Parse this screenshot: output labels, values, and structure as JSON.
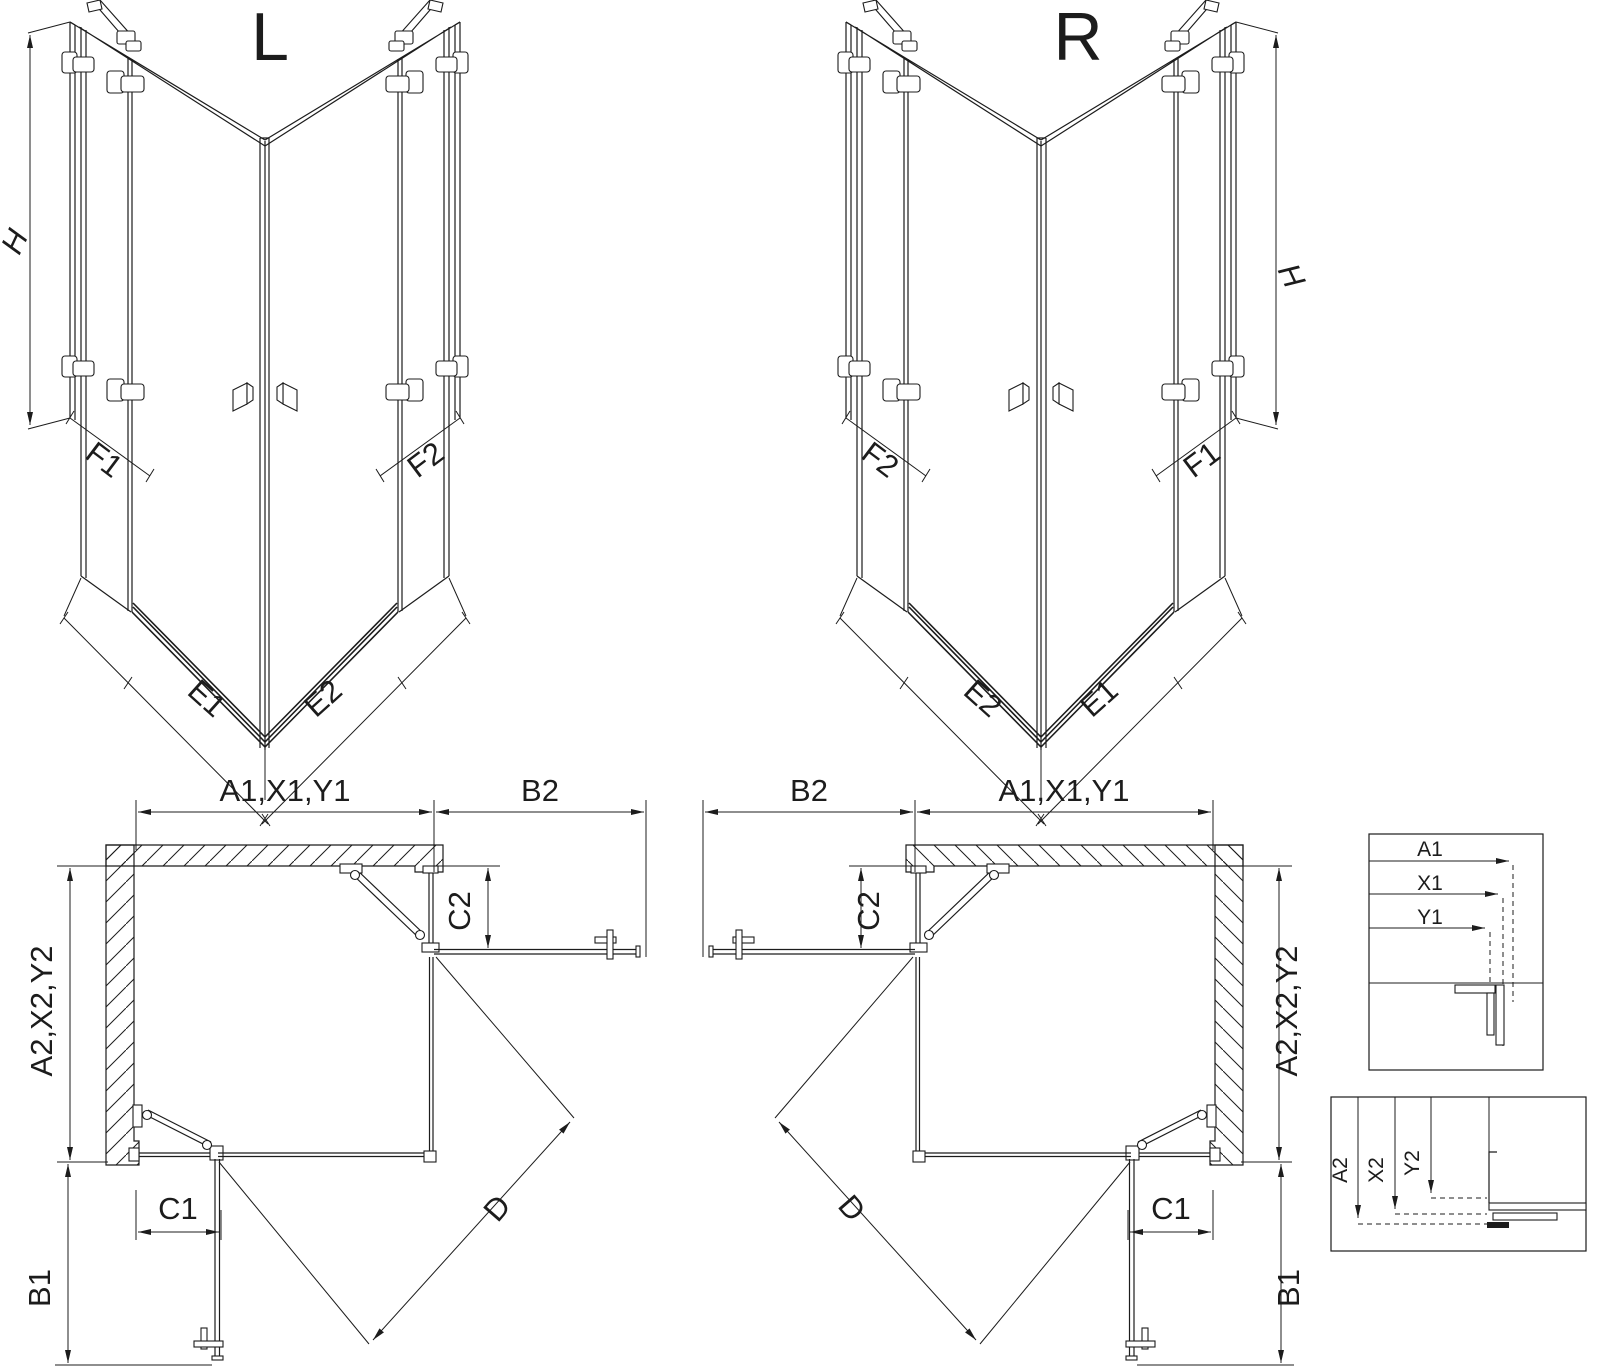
{
  "colors": {
    "line": "#1c1c1c",
    "background": "#ffffff"
  },
  "iso_left": {
    "title": "L",
    "height_label": "H",
    "labels": {
      "f1": "F1",
      "e1": "E1",
      "e2": "E2",
      "f2": "F2"
    }
  },
  "iso_right": {
    "title": "R",
    "height_label": "H",
    "labels": {
      "f1": "F1",
      "e1": "E1",
      "e2": "E2",
      "f2": "F2"
    }
  },
  "plan_left": {
    "top_width": "A1,X1,Y1",
    "open_door_top": "B2",
    "fixed_panel_right": "C2",
    "side_width": "A2,X2,Y2",
    "fixed_panel_bottom": "C1",
    "open_door_bottom": "B1",
    "diagonal_entry": "D"
  },
  "plan_right": {
    "top_width": "A1,X1,Y1",
    "open_door_top": "B2",
    "fixed_panel_right": "C2",
    "side_width": "A2,X2,Y2",
    "fixed_panel_bottom": "C1",
    "open_door_bottom": "B1",
    "diagonal_entry": "D"
  },
  "detail_top": {
    "arrows": [
      "A1",
      "X1",
      "Y1"
    ]
  },
  "detail_bottom": {
    "arrows": [
      "A2",
      "X2",
      "Y2"
    ]
  }
}
